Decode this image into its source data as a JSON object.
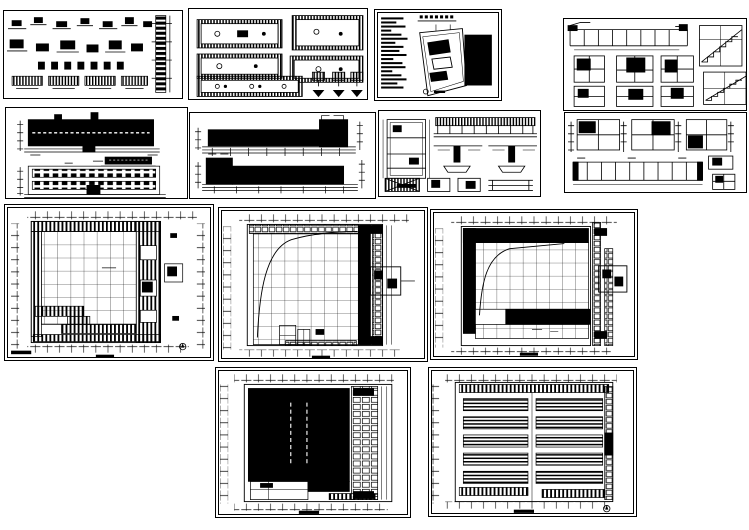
{
  "workspace": {
    "description": "architectural CAD drawing set, multiple sheets on white background",
    "background_color": "#ffffff",
    "ink_color": "#000000",
    "sheet_count": 13
  },
  "sheets": [
    {
      "name": "structural-details-sheet"
    },
    {
      "name": "beam-plan-details-sheet"
    },
    {
      "name": "site-plan-and-notes-sheet"
    },
    {
      "name": "sections-and-stair-details-sheet"
    },
    {
      "name": "building-elevations-sheet-1"
    },
    {
      "name": "building-elevations-sheet-2"
    },
    {
      "name": "roof-plan-and-beam-sections-sheet"
    },
    {
      "name": "wall-sections-sheet"
    },
    {
      "name": "floor-plan-sheet-1"
    },
    {
      "name": "floor-plan-sheet-2"
    },
    {
      "name": "floor-plan-sheet-3"
    },
    {
      "name": "hall-floor-plan-sheet"
    },
    {
      "name": "roof-framing-plan-sheet"
    }
  ]
}
